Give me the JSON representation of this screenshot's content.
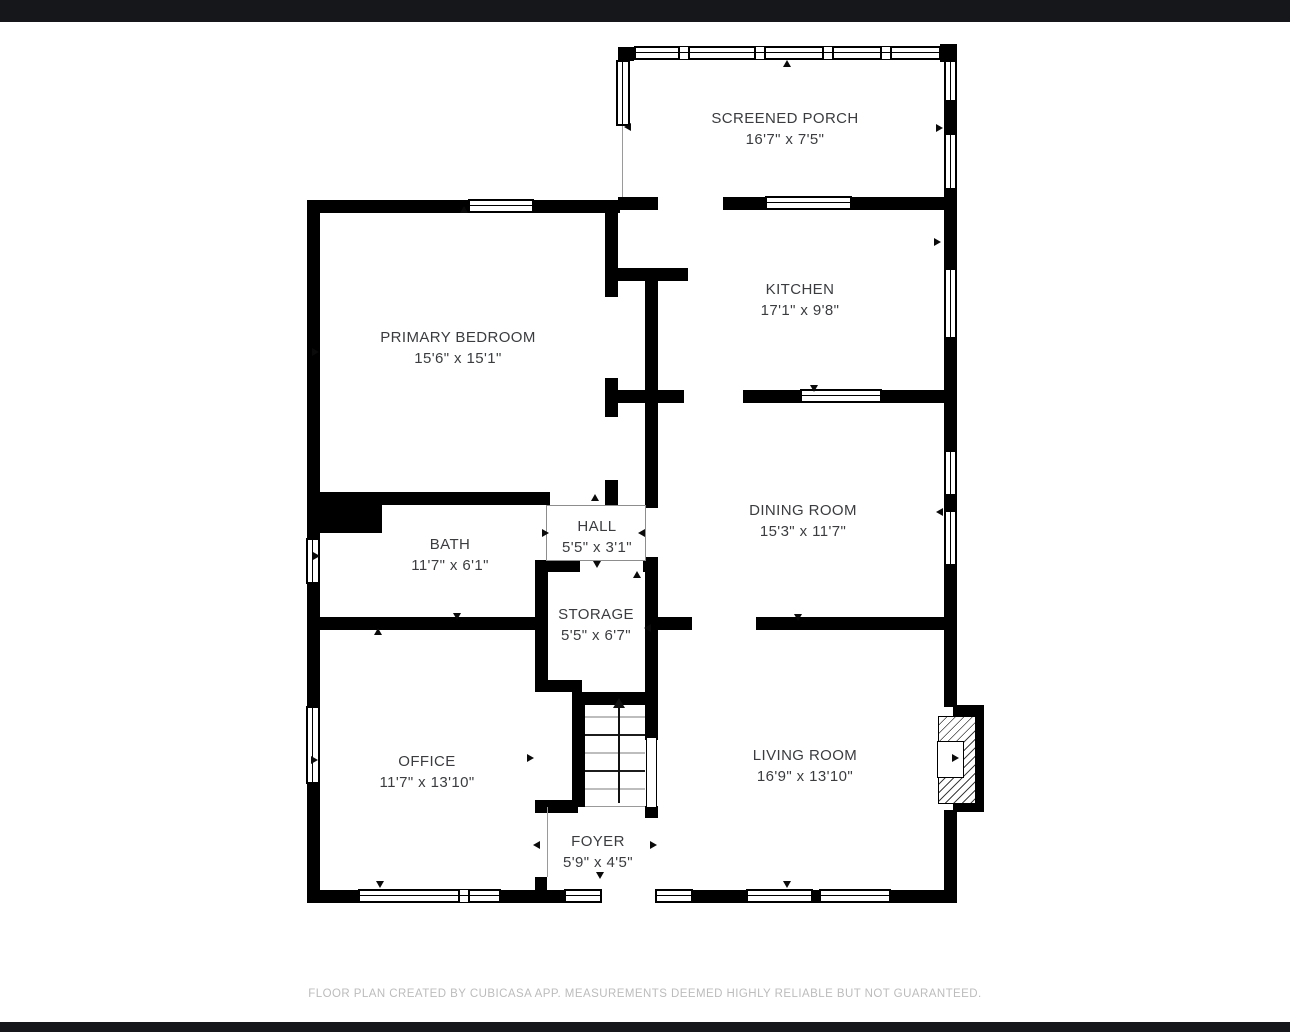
{
  "rooms": [
    {
      "name": "SCREENED PORCH",
      "dims": "16'7\" x 7'5\""
    },
    {
      "name": "KITCHEN",
      "dims": "17'1\" x 9'8\""
    },
    {
      "name": "PRIMARY BEDROOM",
      "dims": "15'6\" x 15'1\""
    },
    {
      "name": "DINING ROOM",
      "dims": "15'3\" x 11'7\""
    },
    {
      "name": "BATH",
      "dims": "11'7\" x 6'1\""
    },
    {
      "name": "HALL",
      "dims": "5'5\" x 3'1\""
    },
    {
      "name": "STORAGE",
      "dims": "5'5\" x 6'7\""
    },
    {
      "name": "OFFICE",
      "dims": "11'7\" x 13'10\""
    },
    {
      "name": "LIVING ROOM",
      "dims": "16'9\" x 13'10\""
    },
    {
      "name": "FOYER",
      "dims": "5'9\" x 4'5\""
    }
  ],
  "footer": {
    "disclaimer": "FLOOR PLAN CREATED BY CUBICASA APP. MEASUREMENTS DEEMED HIGHLY RELIABLE BUT NOT GUARANTEED."
  },
  "colors": {
    "wall": "#000000",
    "background": "#ffffff",
    "letterbox_bar": "#15171b",
    "room_label": "#3a3c3f",
    "disclaimer_text": "#bcbcbc"
  }
}
